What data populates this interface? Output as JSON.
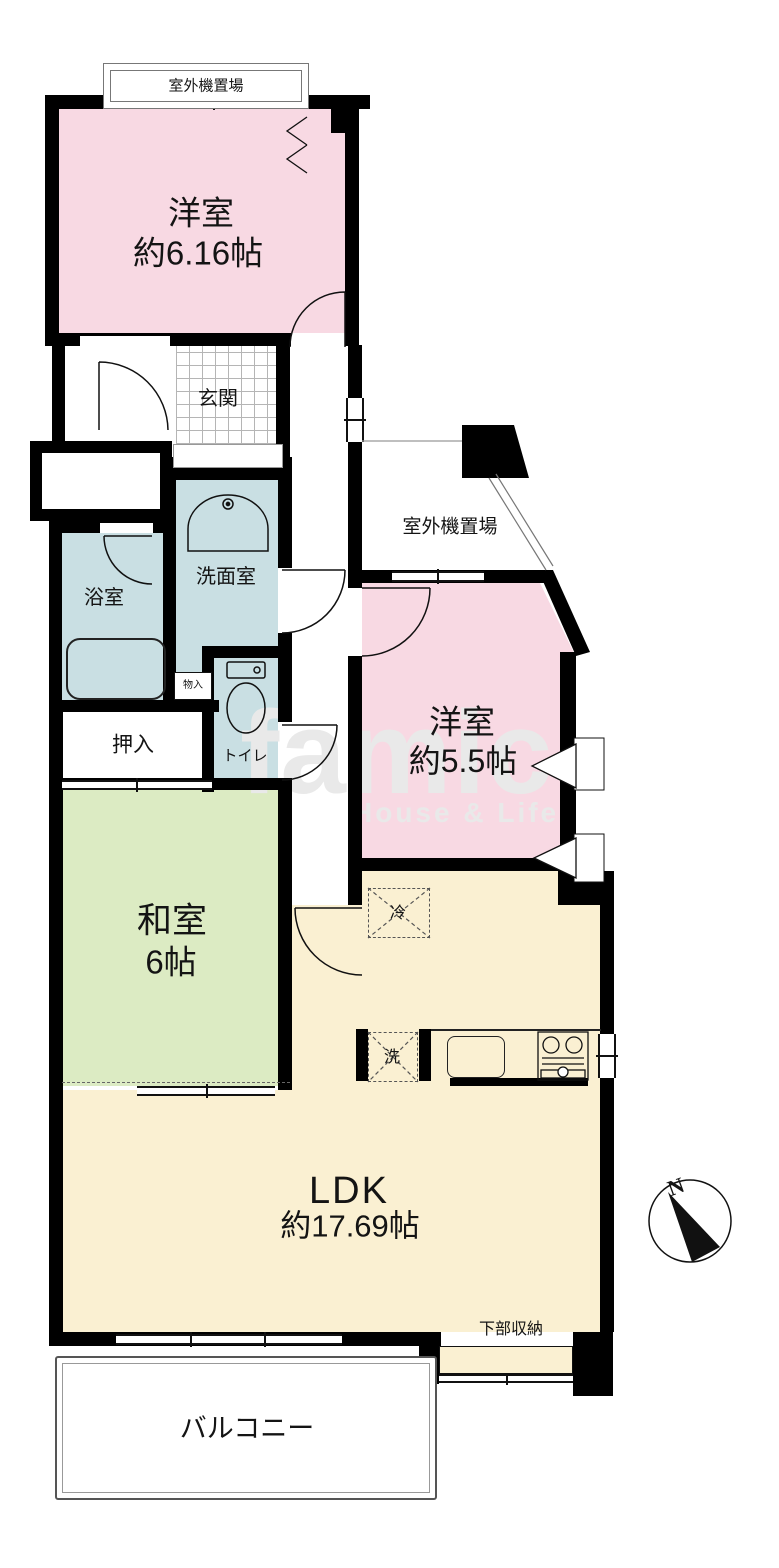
{
  "title": "マンション間取り図",
  "colors": {
    "wall": "#000000",
    "western_room": "#f8d9e3",
    "wet_area": "#c9dfe3",
    "japanese_room": "#dcebc3",
    "ldk": "#faf0d2",
    "watermark": "#e9e9e9"
  },
  "labels": {
    "outdoor_unit_top": "室外機置場",
    "outdoor_unit_mid": "室外機置場",
    "entrance": "玄関",
    "bathroom": "浴室",
    "washroom": "洗面室",
    "small_storage": "物入",
    "toilet": "トイレ",
    "futon_closet": "押入",
    "lower_storage": "下部収納",
    "balcony": "バルコニー",
    "fridge": "冷",
    "washer": "洗",
    "compass_north": "N"
  },
  "rooms": {
    "western1": {
      "name": "洋室",
      "size": "約6.16帖"
    },
    "western2": {
      "name": "洋室",
      "size": "約5.5帖"
    },
    "japanese": {
      "name": "和室",
      "size": "6帖"
    },
    "ldk": {
      "name": "LDK",
      "size": "約17.69帖"
    }
  },
  "watermark": {
    "main": "famic",
    "sub": "House & Life"
  }
}
